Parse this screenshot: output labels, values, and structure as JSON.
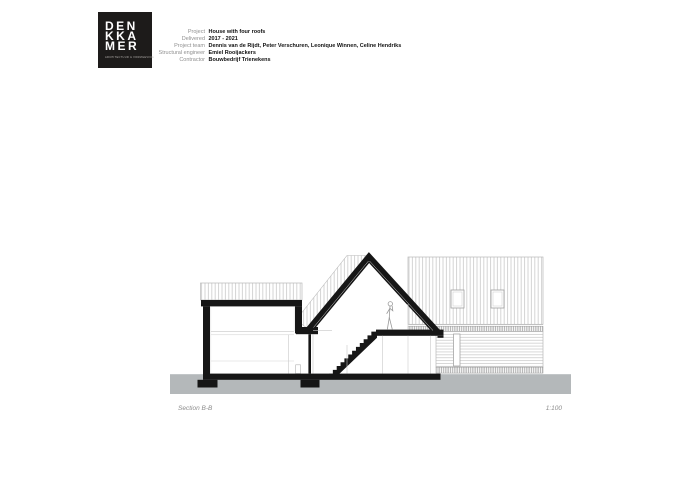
{
  "logo": {
    "name": "DENKKAMER",
    "lines": [
      "DEN",
      "KKA",
      "MER"
    ],
    "tagline": "ARCHITECTUUR & VORMGEVING"
  },
  "project_info": {
    "rows": [
      {
        "label": "Project",
        "value": "House with four roofs"
      },
      {
        "label": "Delivered",
        "value": "2017 - 2021"
      },
      {
        "label": "Project team",
        "value": "Dennis van de Rijdt, Peter Verschuren, Leonique Winnen, Celine Hendriks"
      },
      {
        "label": "Structural engineer",
        "value": "Emiel Rooijackers"
      },
      {
        "label": "Contractor",
        "value": "Bouwbedrijf Trienekens"
      }
    ]
  },
  "drawing": {
    "caption": "Section B-B",
    "scale": "1:100",
    "colors": {
      "ink": "#161616",
      "ground": "#b4b8ba",
      "hatch": "#c2c2c2",
      "caption_text": "#8c8c8c"
    }
  }
}
